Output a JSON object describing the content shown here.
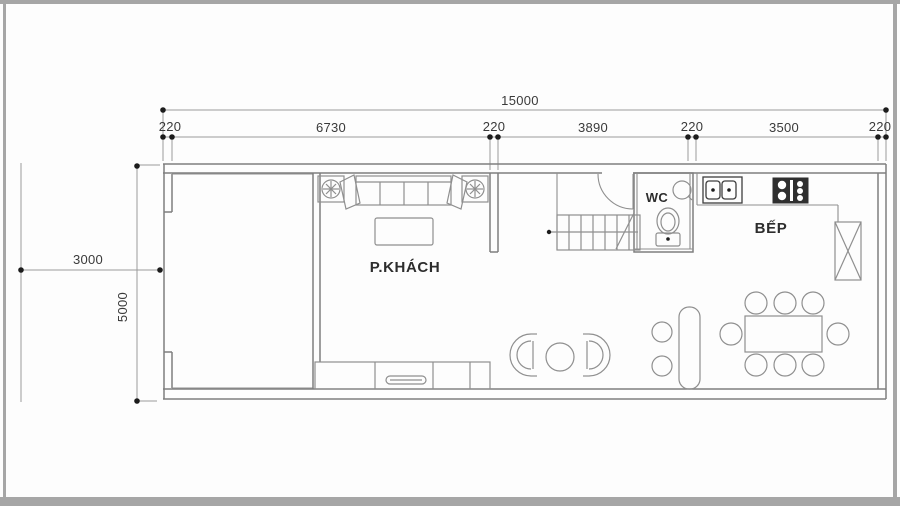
{
  "dimensions": {
    "total": "15000",
    "segments": [
      "220",
      "6730",
      "220",
      "3890",
      "220",
      "3500",
      "220"
    ],
    "setback": "3000",
    "lot_width": "5000"
  },
  "rooms": {
    "living": "P.KHÁCH",
    "wc": "WC",
    "kitchen": "BẾP"
  },
  "colors": {
    "wall": "#7f7f7f",
    "furniture": "#8f8f8f",
    "dimension": "#9a9a9a",
    "text": "#333333",
    "dark_fixture": "#3e3e3e",
    "background": "#fdfdfd",
    "border": "#a6a6a6"
  }
}
